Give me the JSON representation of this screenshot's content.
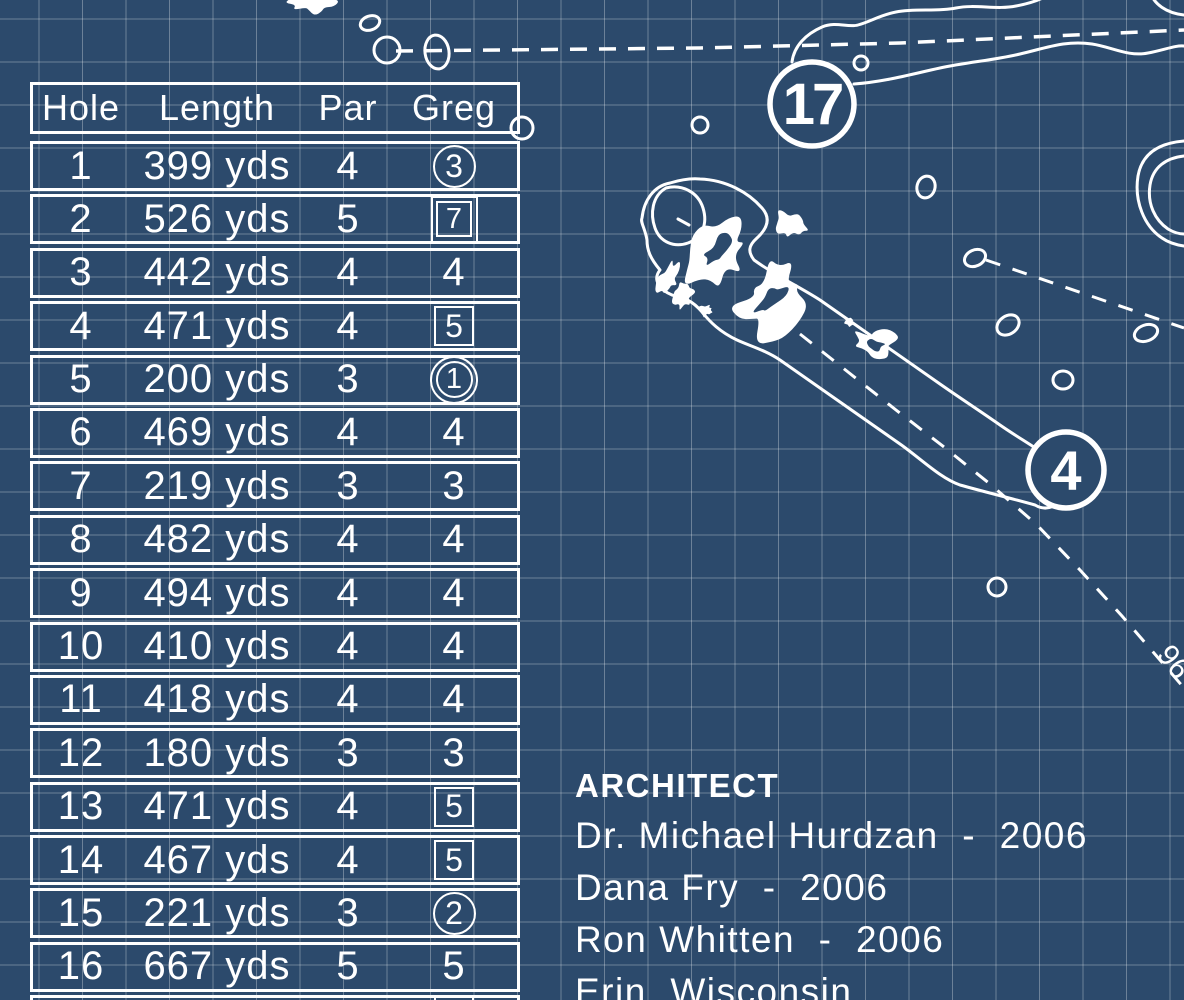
{
  "colors": {
    "background": "#2c4a6c",
    "line": "#ffffff",
    "grid": "rgba(255,255,255,0.30)"
  },
  "scorecard": {
    "headers": [
      "Hole",
      "Length",
      "Par",
      "Greg"
    ],
    "rows": [
      {
        "hole": "1",
        "length": "399 yds",
        "par": "4",
        "score": "3",
        "mark": "circle"
      },
      {
        "hole": "2",
        "length": "526 yds",
        "par": "5",
        "score": "7",
        "mark": "double-square"
      },
      {
        "hole": "3",
        "length": "442 yds",
        "par": "4",
        "score": "4",
        "mark": "none"
      },
      {
        "hole": "4",
        "length": "471 yds",
        "par": "4",
        "score": "5",
        "mark": "square"
      },
      {
        "hole": "5",
        "length": "200 yds",
        "par": "3",
        "score": "1",
        "mark": "double-circle"
      },
      {
        "hole": "6",
        "length": "469 yds",
        "par": "4",
        "score": "4",
        "mark": "none"
      },
      {
        "hole": "7",
        "length": "219 yds",
        "par": "3",
        "score": "3",
        "mark": "none"
      },
      {
        "hole": "8",
        "length": "482 yds",
        "par": "4",
        "score": "4",
        "mark": "none"
      },
      {
        "hole": "9",
        "length": "494 yds",
        "par": "4",
        "score": "4",
        "mark": "none"
      },
      {
        "hole": "10",
        "length": "410 yds",
        "par": "4",
        "score": "4",
        "mark": "none"
      },
      {
        "hole": "11",
        "length": "418 yds",
        "par": "4",
        "score": "4",
        "mark": "none"
      },
      {
        "hole": "12",
        "length": "180 yds",
        "par": "3",
        "score": "3",
        "mark": "none"
      },
      {
        "hole": "13",
        "length": "471 yds",
        "par": "4",
        "score": "5",
        "mark": "square"
      },
      {
        "hole": "14",
        "length": "467 yds",
        "par": "4",
        "score": "5",
        "mark": "square"
      },
      {
        "hole": "15",
        "length": "221 yds",
        "par": "3",
        "score": "2",
        "mark": "circle"
      },
      {
        "hole": "16",
        "length": "667 yds",
        "par": "5",
        "score": "5",
        "mark": "none"
      }
    ],
    "partial_row_visible": true
  },
  "architect": {
    "heading": "ARCHITECT",
    "lines": [
      "Dr. Michael Hurdzan  -  2006",
      "Dana Fry  -  2006",
      "Ron Whitten  -  2006",
      "Erin, Wisconsin"
    ]
  },
  "map": {
    "hole_17_label": "17",
    "hole_4_label": "4",
    "rotated_fragment": "96"
  }
}
